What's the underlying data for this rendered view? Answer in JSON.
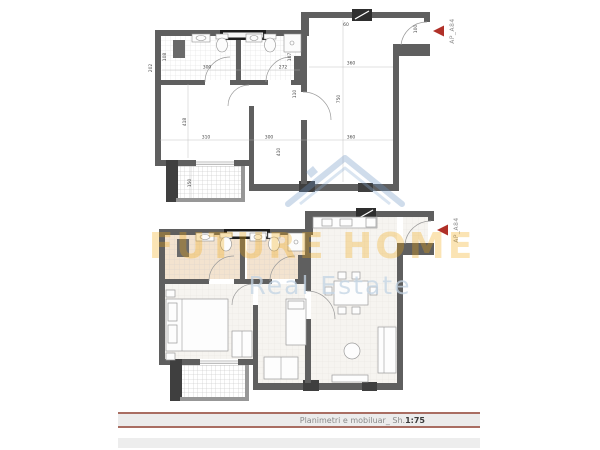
{
  "plan": {
    "ap_label": "AP_A84",
    "dims": [
      "202",
      "300",
      "272",
      "108",
      "107",
      "110",
      "60",
      "100",
      "360",
      "750",
      "360",
      "418",
      "310",
      "300",
      "410",
      "150"
    ]
  },
  "watermark": {
    "brand": "FUTURE HOME",
    "tagline": "Real Estate",
    "logo": "house-roof-logo"
  },
  "title_block": {
    "label": "Planimetri e mobiluar_",
    "scale_prefix": "Sh.",
    "scale": "1:75"
  },
  "colors": {
    "accent_red": "#b03028",
    "title_line": "#a96e63",
    "brand_orange": "#f2a70c",
    "logo_blue": "#6d94c4",
    "wall_gray": "#5f5f5f"
  }
}
